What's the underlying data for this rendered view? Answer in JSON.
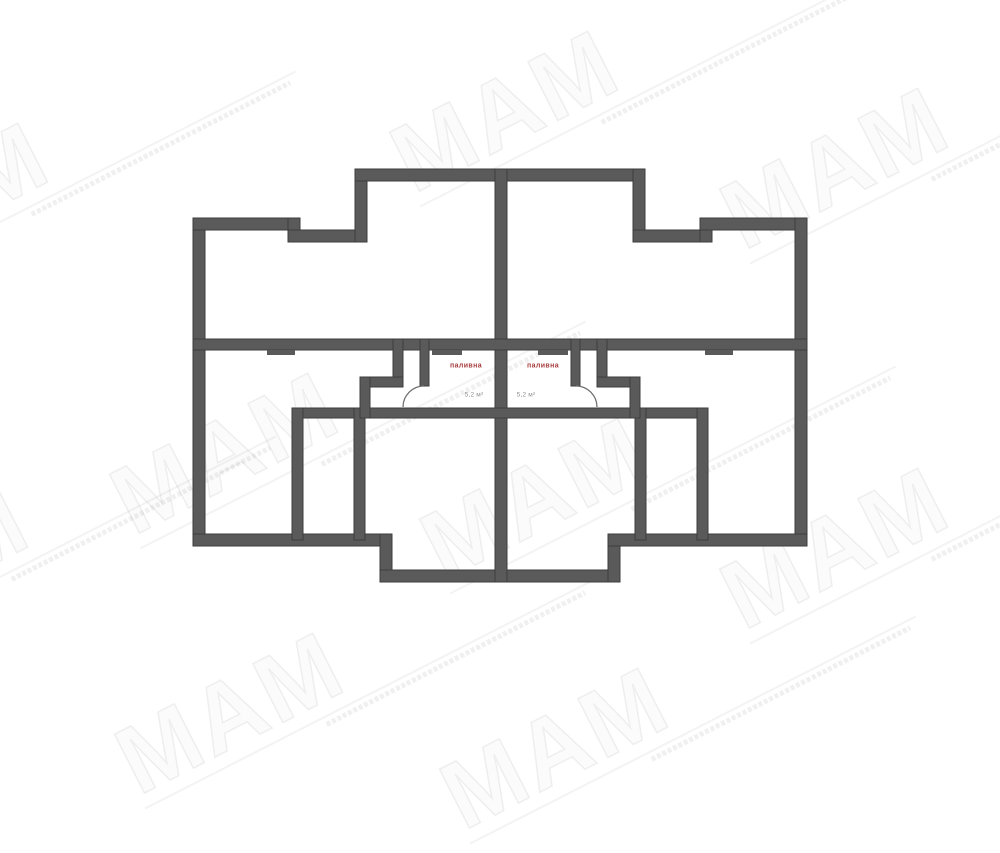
{
  "watermark": {
    "label": "МАМ",
    "color": "rgba(80,80,80,0.085)",
    "positions": [
      {
        "x": 55,
        "y": 150
      },
      {
        "x": 625,
        "y": 58
      },
      {
        "x": 955,
        "y": 115
      },
      {
        "x": 345,
        "y": 400
      },
      {
        "x": 655,
        "y": 445
      },
      {
        "x": 35,
        "y": 515
      },
      {
        "x": 350,
        "y": 660
      },
      {
        "x": 675,
        "y": 695
      },
      {
        "x": 955,
        "y": 495
      }
    ]
  },
  "plan": {
    "wall_color": "#5a5a5a",
    "wall_edge": "#3d3d3d",
    "arc_color": "#6f6f6f",
    "label_color": "#a63c3c",
    "area_color": "#8f8f8f",
    "walls": [
      {
        "name": "left-outer-wall",
        "x": 193,
        "y": 218,
        "w": 12,
        "h": 328
      },
      {
        "name": "top-left-outer-wall",
        "x": 193,
        "y": 218,
        "w": 107,
        "h": 12
      },
      {
        "name": "top-left-step-wall",
        "x": 288,
        "y": 218,
        "w": 12,
        "h": 24
      },
      {
        "name": "top-left-inner-wall",
        "x": 288,
        "y": 230,
        "w": 79,
        "h": 12
      },
      {
        "name": "upper-protrusion-left-wall",
        "x": 355,
        "y": 169,
        "w": 12,
        "h": 73
      },
      {
        "name": "upper-protrusion-top-wall",
        "x": 355,
        "y": 169,
        "w": 290,
        "h": 12
      },
      {
        "name": "upper-protrusion-right-wall",
        "x": 633,
        "y": 169,
        "w": 12,
        "h": 73
      },
      {
        "name": "top-right-inner-wall",
        "x": 633,
        "y": 230,
        "w": 79,
        "h": 12
      },
      {
        "name": "top-right-step-wall",
        "x": 700,
        "y": 218,
        "w": 12,
        "h": 24
      },
      {
        "name": "top-right-outer-wall",
        "x": 700,
        "y": 218,
        "w": 107,
        "h": 12
      },
      {
        "name": "right-outer-wall",
        "x": 795,
        "y": 218,
        "w": 12,
        "h": 328
      },
      {
        "name": "bottom-left-outer-wall",
        "x": 193,
        "y": 534,
        "w": 199,
        "h": 12
      },
      {
        "name": "lower-protrusion-left-wall",
        "x": 380,
        "y": 534,
        "w": 12,
        "h": 48
      },
      {
        "name": "lower-protrusion-bottom-wall",
        "x": 380,
        "y": 570,
        "w": 240,
        "h": 12
      },
      {
        "name": "lower-protrusion-right-wall",
        "x": 608,
        "y": 534,
        "w": 12,
        "h": 48
      },
      {
        "name": "bottom-right-outer-wall",
        "x": 608,
        "y": 534,
        "w": 199,
        "h": 12
      },
      {
        "name": "center-party-wall",
        "x": 495,
        "y": 169,
        "w": 12,
        "h": 413
      },
      {
        "name": "main-horizontal-wall",
        "x": 193,
        "y": 339,
        "w": 614,
        "h": 11
      },
      {
        "name": "lower-horizontal-wall",
        "x": 293,
        "y": 408,
        "w": 414,
        "h": 10
      },
      {
        "name": "left-room-divider-wall-1",
        "x": 292,
        "y": 408,
        "w": 11,
        "h": 132
      },
      {
        "name": "left-room-divider-wall-2",
        "x": 354,
        "y": 408,
        "w": 11,
        "h": 132
      },
      {
        "name": "right-room-divider-wall-1",
        "x": 635,
        "y": 408,
        "w": 11,
        "h": 132
      },
      {
        "name": "right-room-divider-wall-2",
        "x": 697,
        "y": 408,
        "w": 11,
        "h": 132
      },
      {
        "name": "left-flue-wall-upper",
        "x": 393,
        "y": 339,
        "w": 10,
        "h": 41
      },
      {
        "name": "left-flue-wall-horizontal",
        "x": 360,
        "y": 377,
        "w": 43,
        "h": 10
      },
      {
        "name": "left-flue-wall-lower",
        "x": 360,
        "y": 377,
        "w": 10,
        "h": 41
      },
      {
        "name": "left-fuel-room-wall",
        "x": 420,
        "y": 339,
        "w": 9,
        "h": 47
      },
      {
        "name": "right-flue-wall-upper",
        "x": 597,
        "y": 339,
        "w": 10,
        "h": 41
      },
      {
        "name": "right-flue-wall-horizontal",
        "x": 597,
        "y": 377,
        "w": 43,
        "h": 10
      },
      {
        "name": "right-flue-wall-lower",
        "x": 630,
        "y": 377,
        "w": 10,
        "h": 41
      },
      {
        "name": "right-fuel-room-wall",
        "x": 571,
        "y": 339,
        "w": 9,
        "h": 47
      }
    ],
    "lips": [
      {
        "name": "left-wall-niche",
        "x": 267,
        "y": 350,
        "w": 28,
        "h": 5
      },
      {
        "name": "left-fuel-room-niche",
        "x": 432,
        "y": 350,
        "w": 30,
        "h": 5
      },
      {
        "name": "right-fuel-room-niche",
        "x": 538,
        "y": 350,
        "w": 30,
        "h": 5
      },
      {
        "name": "right-wall-niche",
        "x": 705,
        "y": 350,
        "w": 28,
        "h": 5
      }
    ],
    "door_arcs": [
      {
        "name": "left-fuel-room-door-arc",
        "d": "M 403 407 A 21 21 0 0 1 424 386"
      },
      {
        "name": "right-fuel-room-door-arc",
        "d": "M 576 386 A 21 21 0 0 1 597 407"
      }
    ],
    "rooms": [
      {
        "name": "fuel-room-left",
        "label": "паливна",
        "area": "5,2 м²",
        "label_x": 466,
        "label_y": 366,
        "area_x": 474,
        "area_y": 395
      },
      {
        "name": "fuel-room-right",
        "label": "паливна",
        "area": "5,2 м²",
        "label_x": 543,
        "label_y": 366,
        "area_x": 526,
        "area_y": 395
      }
    ]
  }
}
